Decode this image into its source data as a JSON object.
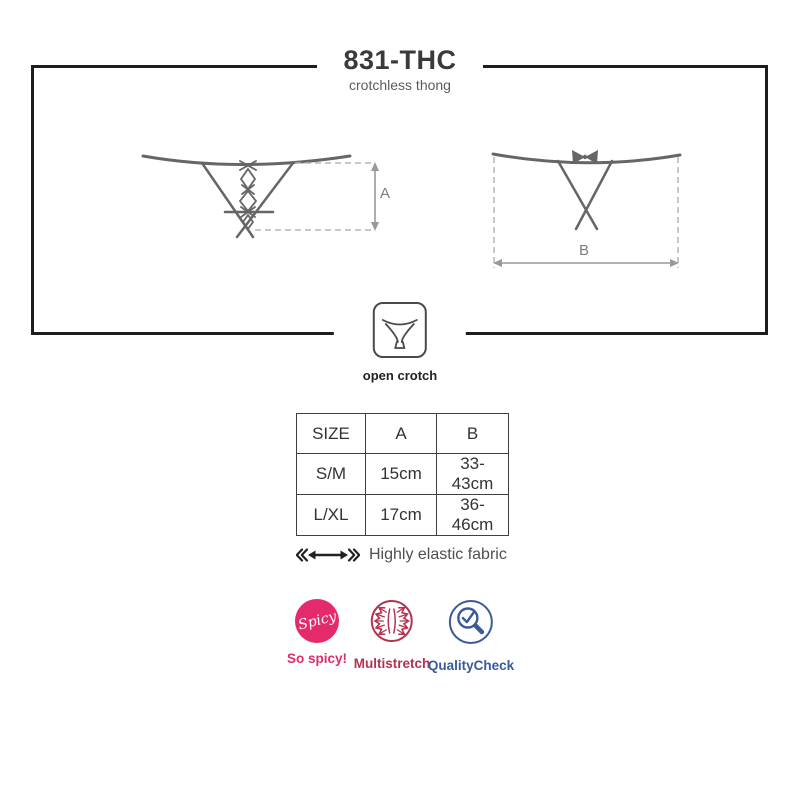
{
  "header": {
    "title": "831-THC",
    "subtitle": "crotchless thong"
  },
  "diagram": {
    "front_measure_label": "A",
    "back_measure_label": "B",
    "open_crotch_label": "open crotch"
  },
  "size_table": {
    "headers": [
      "SIZE",
      "A",
      "B"
    ],
    "rows": [
      [
        "S/M",
        "15cm",
        "33-43cm"
      ],
      [
        "L/XL",
        "17cm",
        "36-46cm"
      ]
    ]
  },
  "elastic": {
    "label": "Highly elastic fabric"
  },
  "badges": [
    {
      "name": "spicy",
      "circle_text": "Spicy",
      "label": "So spicy!",
      "color": "#e5296d"
    },
    {
      "name": "multistretch",
      "label": "Multistretch",
      "color": "#b23350"
    },
    {
      "name": "qualitycheck",
      "label": "QualityCheck",
      "color": "#3a5a9b"
    }
  ],
  "colors": {
    "box_border": "#1d1d1d",
    "drawing_line": "#666666",
    "dashed_line": "#b5b5b5",
    "arrow": "#999999",
    "table_border": "#3f3f3f"
  }
}
